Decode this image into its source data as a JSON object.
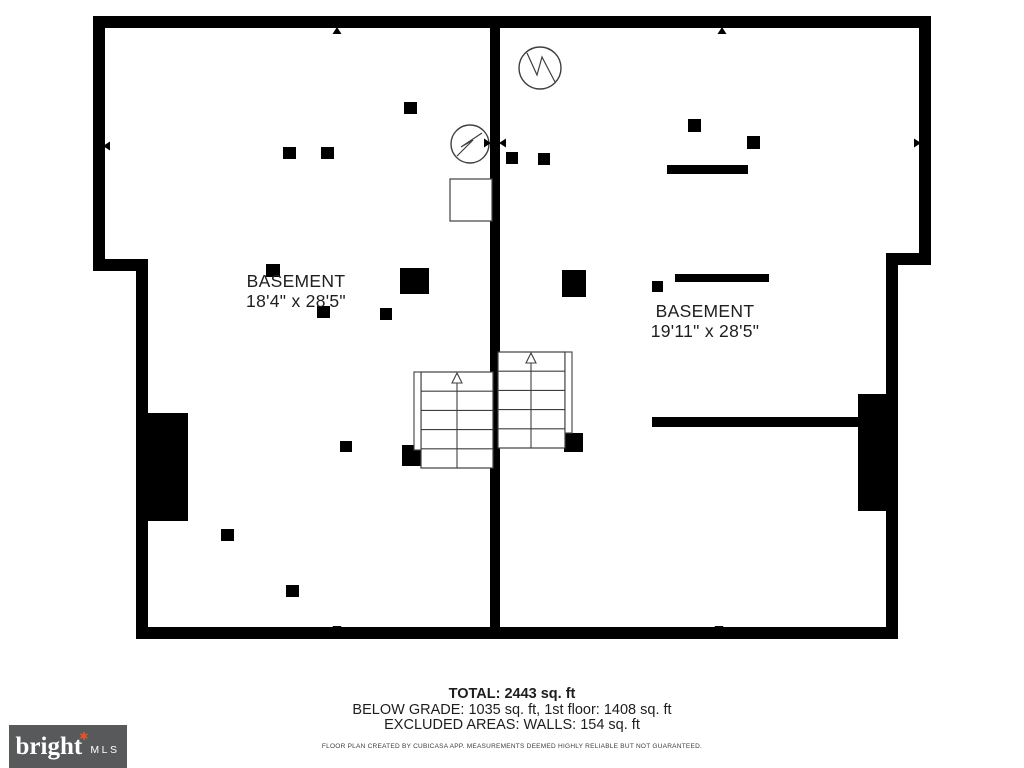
{
  "page": {
    "bg": "#ffffff",
    "ink": "#000000",
    "line": "#3f3f3f",
    "text": "#1e1e1e"
  },
  "plan": {
    "walls": [
      {
        "x": 93,
        "y": 16,
        "w": 838,
        "h": 12
      },
      {
        "x": 93,
        "y": 16,
        "w": 12,
        "h": 255
      },
      {
        "x": 93,
        "y": 259,
        "w": 55,
        "h": 12
      },
      {
        "x": 136,
        "y": 259,
        "w": 12,
        "h": 380
      },
      {
        "x": 136,
        "y": 627,
        "w": 761,
        "h": 12
      },
      {
        "x": 919,
        "y": 16,
        "w": 12,
        "h": 249
      },
      {
        "x": 886,
        "y": 253,
        "w": 45,
        "h": 12
      },
      {
        "x": 886,
        "y": 253,
        "w": 12,
        "h": 386
      },
      {
        "x": 490,
        "y": 16,
        "w": 10,
        "h": 611
      },
      {
        "x": 652,
        "y": 417,
        "w": 207,
        "h": 10
      }
    ],
    "posts": [
      {
        "t": "post",
        "x": 283,
        "y": 147,
        "w": 13,
        "h": 12
      },
      {
        "t": "post",
        "x": 321,
        "y": 147,
        "w": 13,
        "h": 12
      },
      {
        "t": "post",
        "x": 404,
        "y": 102,
        "w": 13,
        "h": 12
      },
      {
        "t": "post",
        "x": 266,
        "y": 264,
        "w": 14,
        "h": 13
      },
      {
        "t": "post",
        "x": 400,
        "y": 268,
        "w": 29,
        "h": 26
      },
      {
        "t": "post",
        "x": 317,
        "y": 306,
        "w": 13,
        "h": 12
      },
      {
        "t": "post",
        "x": 380,
        "y": 308,
        "w": 12,
        "h": 12
      },
      {
        "t": "post",
        "x": 340,
        "y": 441,
        "w": 12,
        "h": 11
      },
      {
        "t": "post",
        "x": 221,
        "y": 529,
        "w": 13,
        "h": 12
      },
      {
        "t": "post",
        "x": 286,
        "y": 585,
        "w": 13,
        "h": 12
      },
      {
        "t": "post",
        "x": 402,
        "y": 445,
        "w": 19,
        "h": 21
      },
      {
        "t": "post",
        "x": 688,
        "y": 119,
        "w": 13,
        "h": 13
      },
      {
        "t": "post",
        "x": 747,
        "y": 136,
        "w": 13,
        "h": 13
      },
      {
        "t": "bar",
        "x": 667,
        "y": 165,
        "w": 81,
        "h": 9
      },
      {
        "t": "post",
        "x": 506,
        "y": 152,
        "w": 12,
        "h": 12
      },
      {
        "t": "post",
        "x": 538,
        "y": 153,
        "w": 12,
        "h": 12
      },
      {
        "t": "post",
        "x": 562,
        "y": 270,
        "w": 24,
        "h": 27
      },
      {
        "t": "post",
        "x": 652,
        "y": 281,
        "w": 11,
        "h": 11
      },
      {
        "t": "bar",
        "x": 675,
        "y": 274,
        "w": 94,
        "h": 8
      },
      {
        "t": "post",
        "x": 564,
        "y": 433,
        "w": 19,
        "h": 19
      },
      {
        "t": "mass",
        "x": 148,
        "y": 413,
        "w": 40,
        "h": 108
      },
      {
        "t": "mass",
        "x": 858,
        "y": 394,
        "w": 31,
        "h": 117
      }
    ],
    "boxes": [
      {
        "x": 450,
        "y": 179,
        "w": 42,
        "h": 42
      }
    ],
    "circles": [
      {
        "cx": 470,
        "cy": 144,
        "r": 19,
        "points": "482,133 461,147 473,140 457,156"
      },
      {
        "cx": 540,
        "cy": 68,
        "r": 21,
        "points": "527,53 537,75 542,57 555,82"
      }
    ],
    "stairs": [
      {
        "x": 421,
        "y": 372,
        "w": 72,
        "h": 96,
        "steps": 5,
        "rail": {
          "x": 414,
          "y": 372,
          "w": 7,
          "h": 78
        },
        "arrow": {
          "x": 457,
          "top": 373
        }
      },
      {
        "x": 498,
        "y": 352,
        "w": 67,
        "h": 96,
        "steps": 5,
        "rail": {
          "x": 565,
          "y": 352,
          "w": 7,
          "h": 81
        },
        "arrow": {
          "x": 531,
          "top": 353
        }
      }
    ],
    "markers": [
      {
        "cx": 337,
        "cy": 27,
        "dir": "up"
      },
      {
        "cx": 722,
        "cy": 27,
        "dir": "up"
      },
      {
        "cx": 337,
        "cy": 633,
        "dir": "down"
      },
      {
        "cx": 719,
        "cy": 633,
        "dir": "down"
      },
      {
        "cx": 103,
        "cy": 146,
        "dir": "left"
      },
      {
        "cx": 921,
        "cy": 143,
        "dir": "right"
      },
      {
        "cx": 491,
        "cy": 143,
        "dir": "right"
      },
      {
        "cx": 499,
        "cy": 143,
        "dir": "left"
      }
    ],
    "rooms": [
      {
        "name": "BASEMENT",
        "dims": "18'4\" x 28'5\"",
        "cx": 296,
        "top": 271
      },
      {
        "name": "BASEMENT",
        "dims": "19'11\" x 28'5\"",
        "cx": 705,
        "top": 301
      }
    ]
  },
  "footer": {
    "total": "TOTAL: 2443 sq. ft",
    "line2": "BELOW GRADE: 1035 sq. ft, 1st floor: 1408 sq. ft",
    "line3": "EXCLUDED AREAS: WALLS: 154 sq. ft",
    "disclaimer": "FLOOR PLAN CREATED BY CUBICASA APP. MEASUREMENTS DEEMED HIGHLY RELIABLE BUT NOT GUARANTEED."
  },
  "logo": {
    "brand": "bright",
    "mark": "✱",
    "suffix": "MLS",
    "bg": "#58595b",
    "accent": "#e0552b",
    "fg": "#ffffff"
  }
}
